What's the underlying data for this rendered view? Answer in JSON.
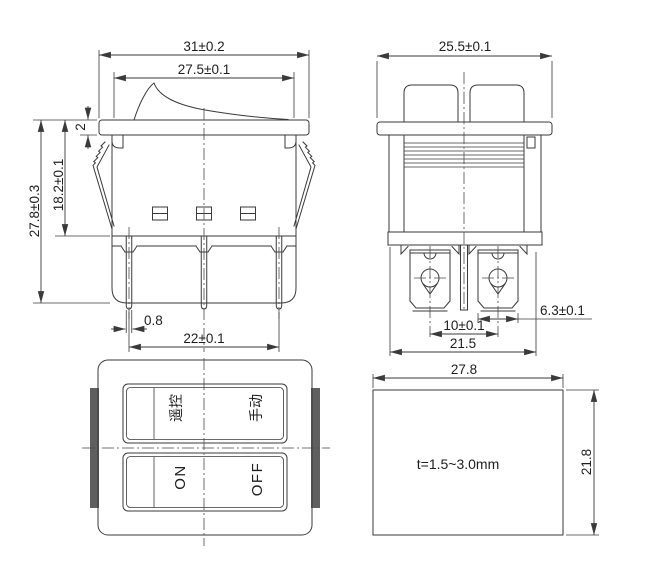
{
  "title": "Rocker switch dimensional drawing",
  "colors": {
    "line": "#3a3a3a",
    "mount_clip": "#5f5f5f",
    "background": "#ffffff"
  },
  "views": {
    "front": {
      "dims": {
        "flange_width": "31±0.2",
        "rocker_width": "27.5±0.1",
        "flange_thickness": "2",
        "body_depth": "18.2±0.1",
        "total_height": "27.8±0.3",
        "pin_thickness": "0.8",
        "pin_pitch": "22±0.1"
      }
    },
    "side": {
      "dims": {
        "flange_width": "25.5±0.1",
        "terminal_width": "6.3±0.1",
        "terminal_pitch": "10±0.1",
        "body_width": "21.5"
      }
    },
    "face": {
      "labels": {
        "remote": "遥控",
        "manual": "手动",
        "on": "ON",
        "off": "OFF"
      }
    },
    "panel_cutout": {
      "dims": {
        "width": "27.8",
        "height": "21.8"
      },
      "note": "t=1.5~3.0mm"
    }
  }
}
